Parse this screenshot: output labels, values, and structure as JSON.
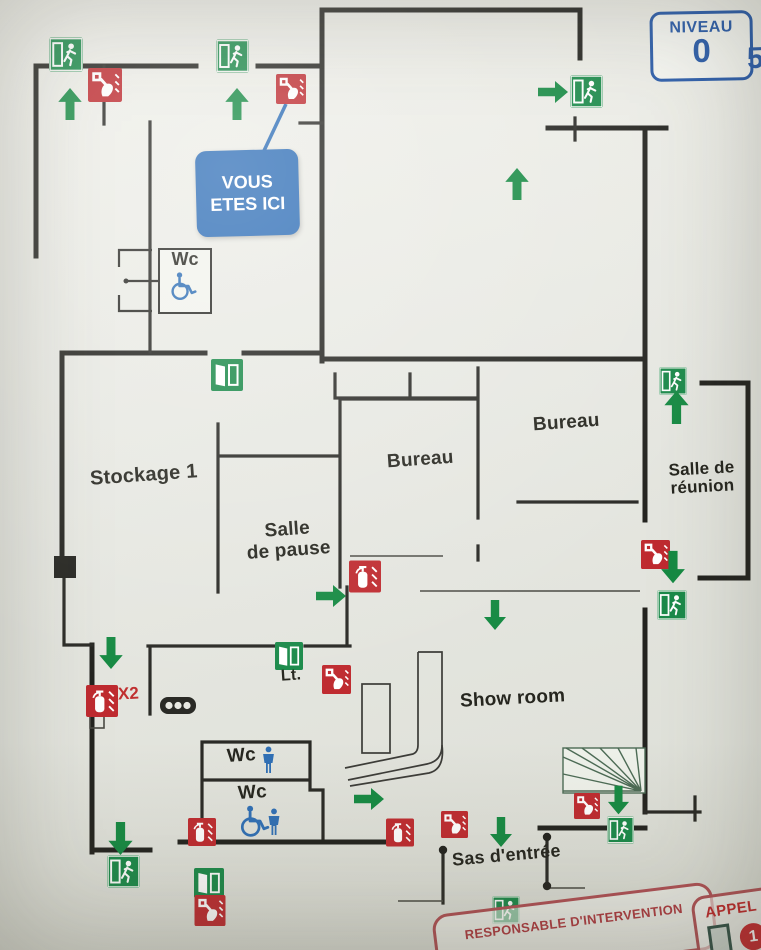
{
  "plan": {
    "niveau": {
      "title": "NIVEAU",
      "level": "0"
    },
    "you_are_here": {
      "line1": "VOUS",
      "line2": "ETES ICI"
    },
    "edge_partial_text": "5"
  },
  "rooms": {
    "stockage": "Stockage 1",
    "salle_pause_l1": "Salle",
    "salle_pause_l2": "de pause",
    "bureau_left": "Bureau",
    "bureau_right": "Bureau",
    "salle_reunion_l1": "Salle de",
    "salle_reunion_l2": "réunion",
    "showroom": "Show room",
    "sas_entree": "Sas d'entrée",
    "local_technique": "Lt.",
    "wc_top": "Wc",
    "wc_male": "Wc",
    "wc_accessible": "Wc"
  },
  "marks": {
    "extinguisher_count": "X2"
  },
  "banners": {
    "responsable": "RESPONSABLE D'INTERVENTION",
    "appel": "APPEL S",
    "appel_number": "1"
  },
  "colors": {
    "exit_green": "#1b8a4a",
    "safety_red": "#bf2b30",
    "info_blue": "#2d6db6",
    "niveau_blue": "#2b5ca9",
    "wall": "#23231f"
  },
  "icons": {
    "exit_sign": "running-man-in-door",
    "emergency_door": "open-door",
    "fire_call_point": "hand-pressing-button",
    "fire_extinguisher": "extinguisher",
    "direction_arrow": "solid-green-arrow",
    "wheelchair": "wheelchair-accessibility",
    "toilet_person": "standing-person",
    "stairs": "winder-stairs"
  }
}
